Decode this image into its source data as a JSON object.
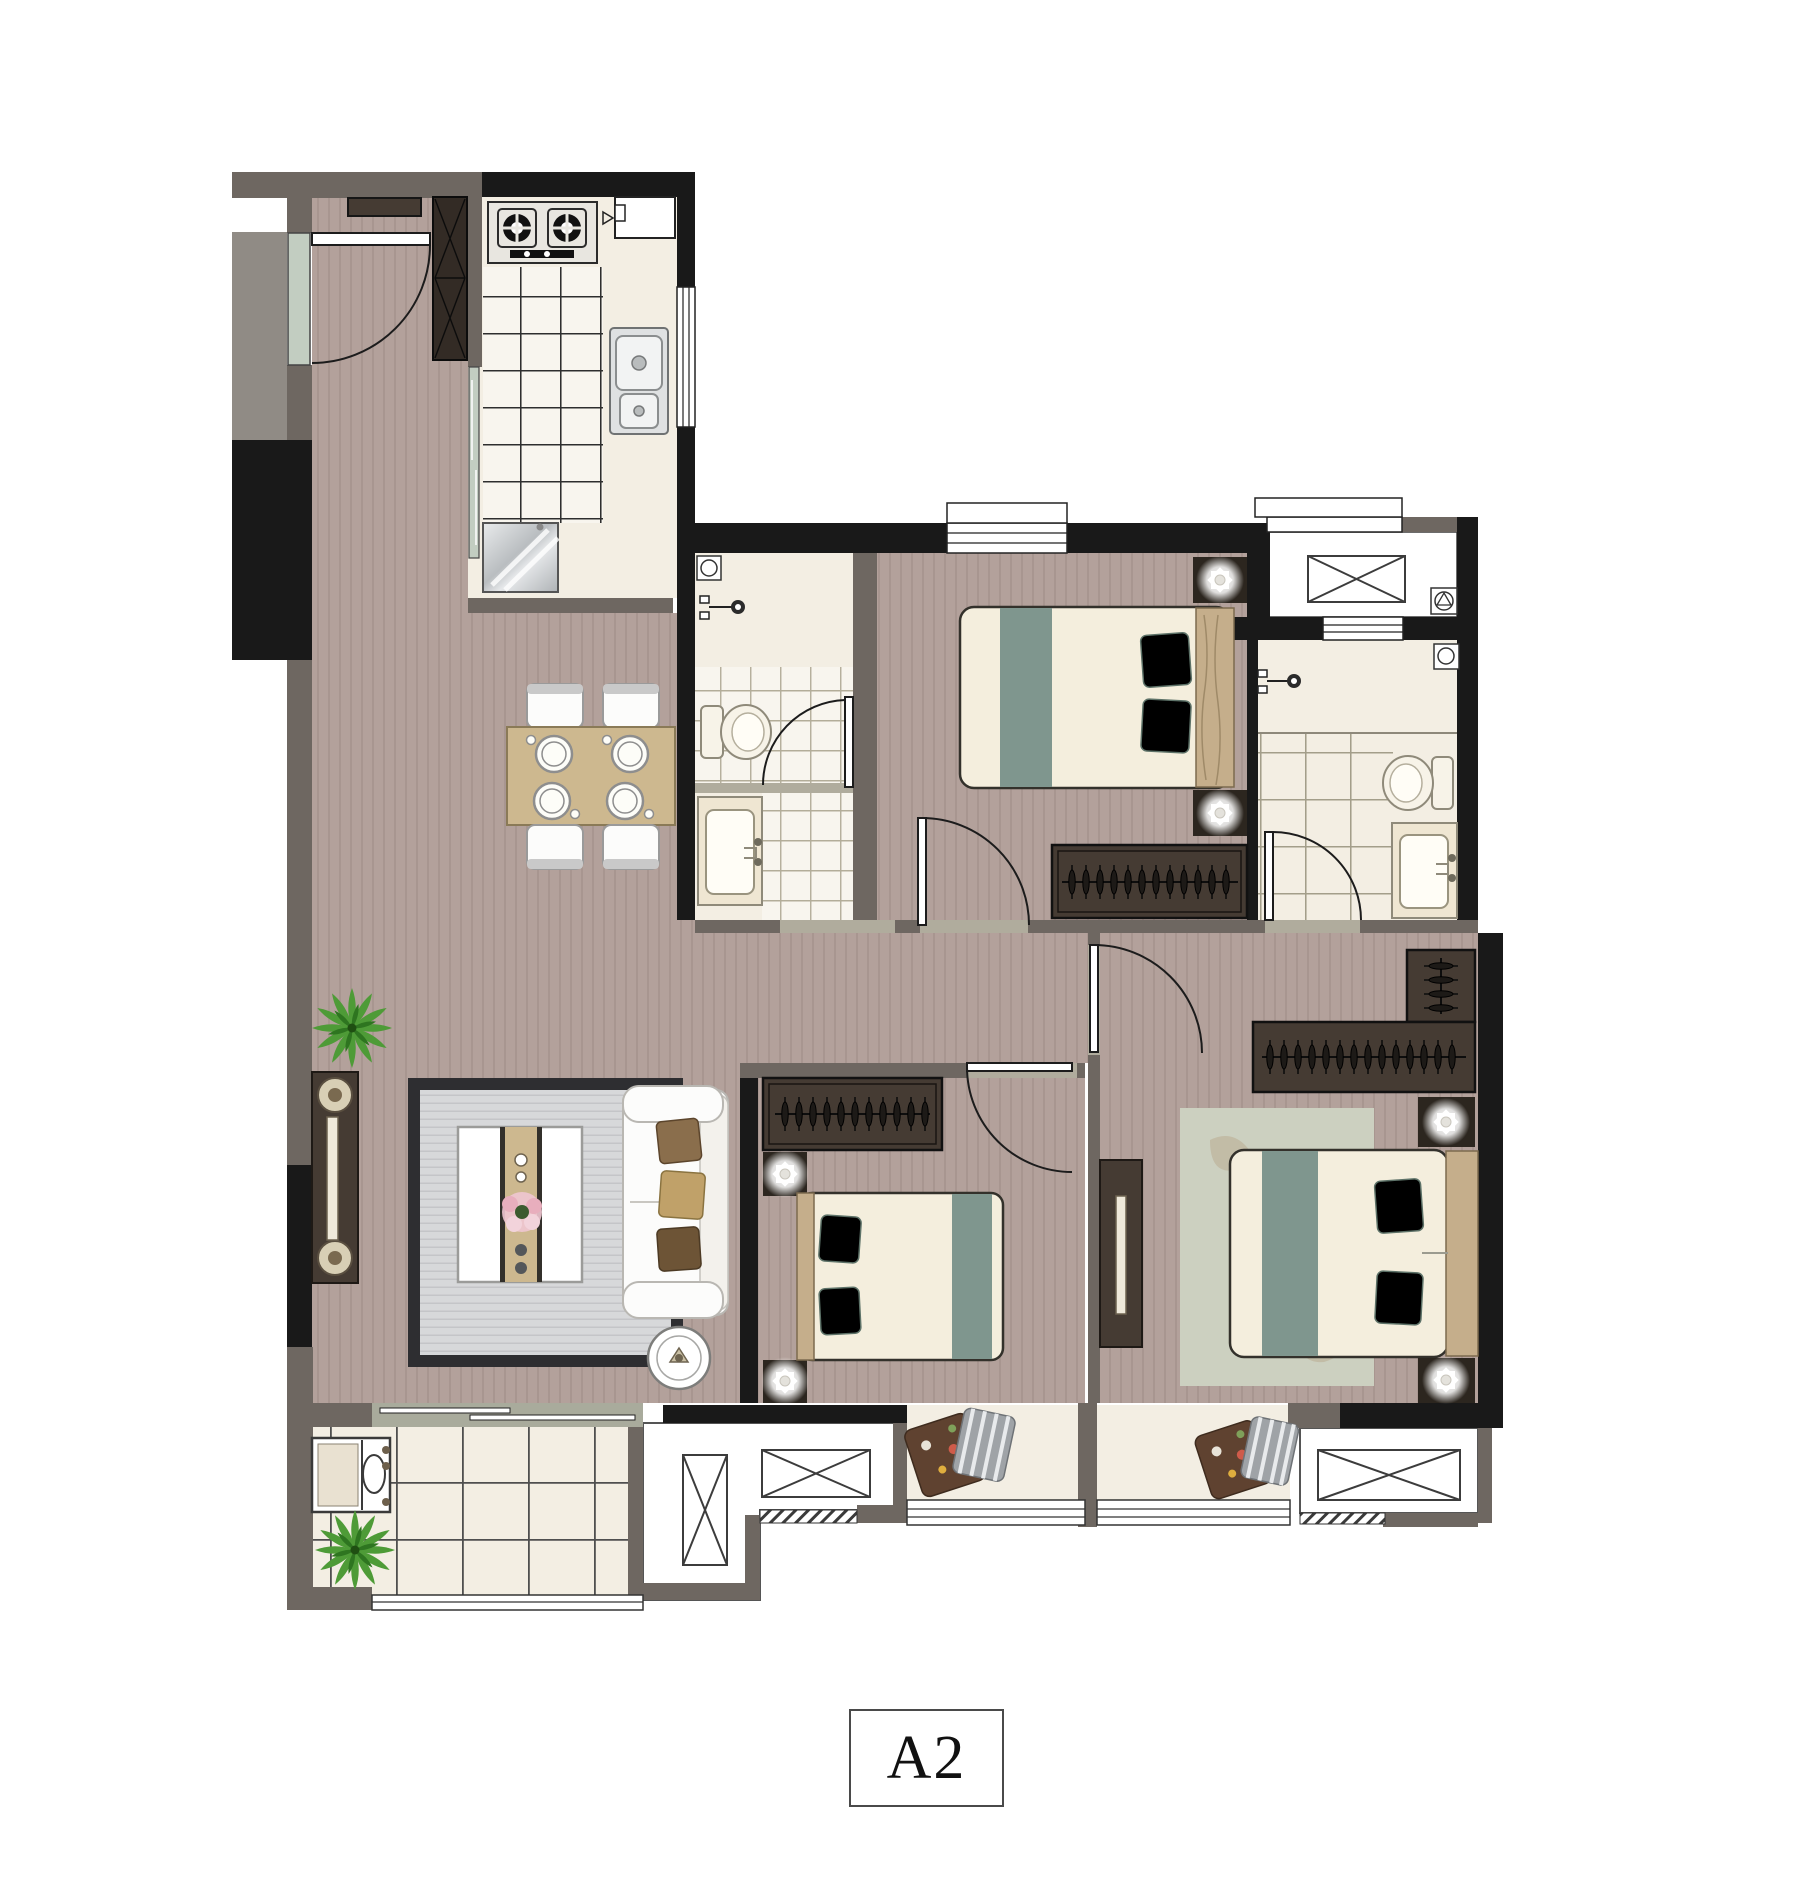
{
  "plan": {
    "unit_label": "A2"
  },
  "colors": {
    "white": "#ffffff",
    "wall_black": "#191919",
    "wall_gray": "#6e6761",
    "shaft_gray": "#908b85",
    "floor_wood": "#b3a19b",
    "wood_stripe": "#97867f",
    "floor_marble": "#f3eee3",
    "counter_tile": "#f8f5ee",
    "tile_line": "#2e2e2e",
    "bath_tile_line": "#b3ad99",
    "bath2_tile_line": "#a39e8a",
    "balcony_tile_line": "#4f4f4f",
    "marble_sill": "#a9ab9c",
    "threshold": "#b0ac9d",
    "glass": "#c2cdc1",
    "rug_gray": "#d7d8da",
    "rug_border": "#2e2e31",
    "rug_master": "#ccd0c0",
    "table_wood": "#cdb88f",
    "dark_wood": "#453b33",
    "darker_wood": "#332b25",
    "bed_sheet": "#f4eedd",
    "bed_teal": "#7f968e",
    "headboard": "#c5ae8b",
    "sofa_white": "#fcfcfb",
    "pillow_brown1": "#8a6e4c",
    "pillow_brown2": "#c0a169",
    "pillow_brown3": "#6d5436",
    "floral_brown": "#5f4230",
    "stripe_pillow": "#9fa3a7",
    "plant_green": "#4e9b37",
    "plant_dark": "#2e7520",
    "steel": "#c9ccce",
    "label_border": "#4a4a4a",
    "text": "#111111"
  },
  "icons": {
    "stove-icon": "two burner circles with cross grates",
    "kitchen-sink-icon": "double bowl steel sink",
    "fridge-icon": "silver square with shine",
    "toilet-icon": "tank plus oval bowl",
    "basin-icon": "counter with rectangular basin",
    "shower-icon": "wall stem with round head",
    "washing-machine-icon": "square, circle and triangle",
    "floor-drain-icon": "square with circle",
    "ac-unit-icon": "rectangle with diagonal cross",
    "hanger-rail-icon": "rail with clothes hangers",
    "lamp-icon": "glowing flower on dark pad",
    "plant-icon": "leafy starburst",
    "door-swing-icon": "leaf with quarter arc"
  }
}
